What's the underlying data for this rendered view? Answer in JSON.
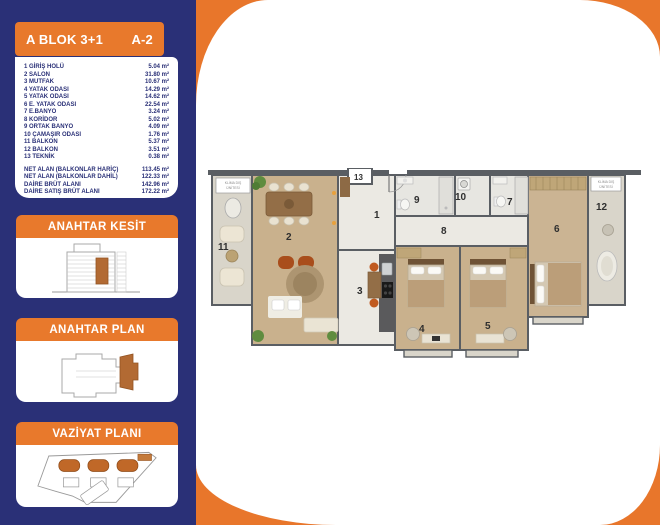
{
  "sidebar": {
    "header": {
      "block": "A BLOK 3+1",
      "unit": "A-2"
    },
    "rooms": [
      {
        "no": "1",
        "name": "GİRİŞ HOLÜ",
        "area": "5.04 m²"
      },
      {
        "no": "2",
        "name": "SALON",
        "area": "31.80 m²"
      },
      {
        "no": "3",
        "name": "MUTFAK",
        "area": "10.67 m²"
      },
      {
        "no": "4",
        "name": "YATAK ODASI",
        "area": "14.29 m²"
      },
      {
        "no": "5",
        "name": "YATAK ODASI",
        "area": "14.62 m²"
      },
      {
        "no": "6",
        "name": "E. YATAK ODASI",
        "area": "22.54 m²"
      },
      {
        "no": "7",
        "name": "E.BANYO",
        "area": "3.24 m²"
      },
      {
        "no": "8",
        "name": "KORİDOR",
        "area": "5.02 m²"
      },
      {
        "no": "9",
        "name": "ORTAK BANYO",
        "area": "4.09 m²"
      },
      {
        "no": "10",
        "name": "ÇAMAŞIR ODASI",
        "area": "1.76 m²"
      },
      {
        "no": "11",
        "name": "BALKON",
        "area": "5.37 m²"
      },
      {
        "no": "12",
        "name": "BALKON",
        "area": "3.51 m²"
      },
      {
        "no": "13",
        "name": "TEKNİK",
        "area": "0.38 m²"
      }
    ],
    "summary": [
      {
        "label": "NET ALAN (BALKONLAR HARİÇ)",
        "value": "113.45 m²"
      },
      {
        "label": "NET ALAN (BALKONLAR DAHİL)",
        "value": "122.33 m²"
      },
      {
        "label": "DAİRE BRÜT ALANI",
        "value": "142.96 m²"
      },
      {
        "label": "DAİRE SATIŞ BRÜT ALANI",
        "value": "172.22 m²"
      }
    ],
    "sections": [
      {
        "title": "ANAHTAR KESİT"
      },
      {
        "title": "ANAHTAR PLAN"
      },
      {
        "title": "VAZİYAT PLANI"
      }
    ]
  },
  "plan": {
    "numbers": [
      "1",
      "2",
      "3",
      "4",
      "5",
      "6",
      "7",
      "8",
      "9",
      "10",
      "11",
      "12",
      "13"
    ],
    "ac_unit_label": [
      "KLİMA DIŞ",
      "ÜNİTESİ"
    ]
  },
  "colors": {
    "sidebar_navy": "#2a3077",
    "accent_orange": "#e8792c",
    "panel_orange": "#e8762b",
    "highlight_brown": "#b26a33",
    "wall_gray": "#5a5e63"
  }
}
